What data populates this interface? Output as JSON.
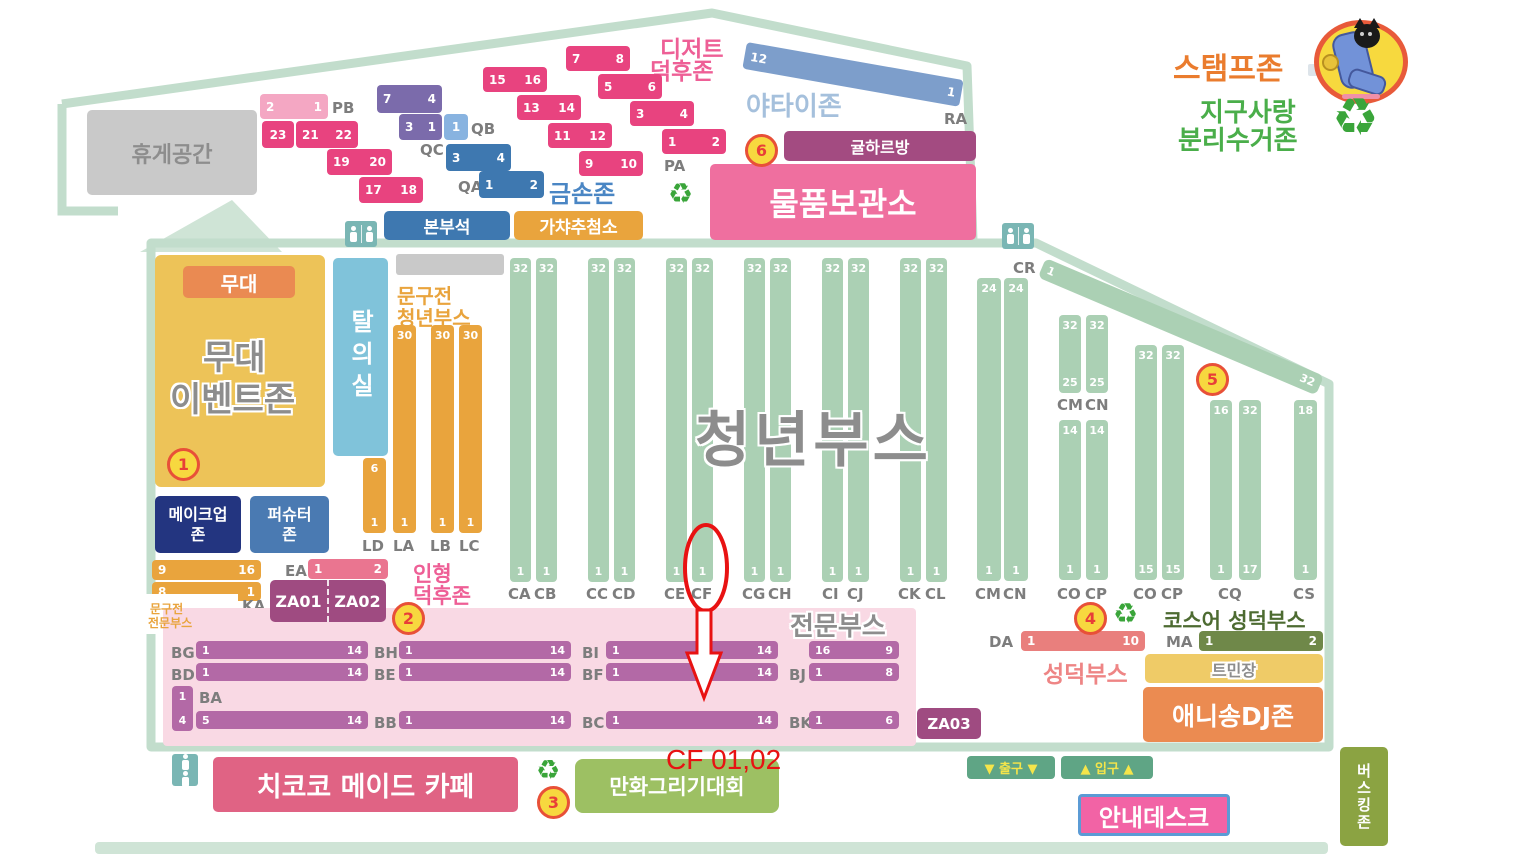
{
  "annotation": {
    "label": "CF 01,02"
  },
  "header": {
    "stamp_zone": "스탬프존",
    "earth_line1": "지구사랑",
    "earth_line2": "분리수거존"
  },
  "icons": {
    "recycle": "♻"
  },
  "rest_area": {
    "label": "휴게공간"
  },
  "nw": {
    "pb": {
      "label": "PB",
      "a": "2",
      "b": "1"
    },
    "b23": {
      "a": "23"
    },
    "b2122": {
      "a": "21",
      "b": "22"
    },
    "b1920": {
      "a": "19",
      "b": "20"
    },
    "b1718": {
      "a": "17",
      "b": "18"
    },
    "v74": {
      "a": "7",
      "b": "4"
    },
    "v31": {
      "a": "3",
      "b": "1"
    },
    "qb": {
      "label": "QB",
      "a": "1"
    },
    "qc_label": "QC",
    "b34": {
      "a": "3",
      "b": "4"
    },
    "qa": {
      "label": "QA",
      "a": "1",
      "b": "2"
    },
    "goldhand": "금손존",
    "hq": "본부석",
    "gacha": "가챠추첨소"
  },
  "dessert": {
    "title1": "디저트",
    "title2": "덕후존",
    "d78": {
      "a": "7",
      "b": "8"
    },
    "d1516": {
      "a": "15",
      "b": "16"
    },
    "d56": {
      "a": "5",
      "b": "6"
    },
    "d1314": {
      "a": "13",
      "b": "14"
    },
    "d34": {
      "a": "3",
      "b": "4"
    },
    "d1112": {
      "a": "11",
      "b": "12"
    },
    "d12": {
      "a": "1",
      "b": "2"
    },
    "d910": {
      "a": "9",
      "b": "10"
    },
    "pa_label": "PA"
  },
  "ne": {
    "yatai": "야타이존",
    "ra": {
      "label": "RA",
      "a": "12",
      "b": "1"
    },
    "gyul": "귤하르방",
    "storage": "물품보관소"
  },
  "markers": {
    "m1": "1",
    "m2": "2",
    "m3": "3",
    "m4": "4",
    "m5": "5",
    "m6": "6"
  },
  "stage": {
    "header": "무대",
    "title1": "무대",
    "title2": "이벤트존"
  },
  "dressing": {
    "label": "탈의실"
  },
  "stationery_youth": {
    "title1": "문구전",
    "title2": "청년부스",
    "ld": {
      "label": "LD",
      "top": "6",
      "bottom": "1"
    },
    "la": {
      "label": "LA",
      "top": "30",
      "bottom": "1"
    },
    "lb": {
      "label": "LB",
      "top": "30",
      "bottom": "1"
    },
    "lc": {
      "label": "LC",
      "top": "30",
      "bottom": "1"
    }
  },
  "makeup": {
    "line1": "메이크업",
    "line2": "존"
  },
  "fursuiter": {
    "line1": "퍼슈터",
    "line2": "존"
  },
  "stationery_pro": {
    "bar1": {
      "a": "9",
      "b": "16"
    },
    "bar2": {
      "a": "8",
      "b": "1"
    },
    "ka_label": "KA",
    "title1": "문구전",
    "title2": "전문부스"
  },
  "doll": {
    "ea_label": "EA",
    "bar": {
      "a": "1",
      "b": "2"
    },
    "title1": "인형",
    "title2": "덕후존"
  },
  "za": {
    "za01": "ZA01",
    "za02": "ZA02",
    "za03": "ZA03"
  },
  "youth": {
    "title": "청년부스",
    "ca": {
      "label": "CA",
      "top": "32",
      "bottom": "1"
    },
    "cb": {
      "label": "CB",
      "top": "32",
      "bottom": "1"
    },
    "cc": {
      "label": "CC",
      "top": "32",
      "bottom": "1"
    },
    "cd": {
      "label": "CD",
      "top": "32",
      "bottom": "1"
    },
    "ce": {
      "label": "CE",
      "top": "32",
      "bottom": "1"
    },
    "cf": {
      "label": "CF",
      "top": "32",
      "bottom": "1"
    },
    "cg": {
      "label": "CG",
      "top": "32",
      "bottom": "1"
    },
    "ch": {
      "label": "CH",
      "top": "32",
      "bottom": "1"
    },
    "ci": {
      "label": "CI",
      "top": "32",
      "bottom": "1"
    },
    "cj": {
      "label": "CJ",
      "top": "32",
      "bottom": "1"
    },
    "ck": {
      "label": "CK",
      "top": "32",
      "bottom": "1"
    },
    "cl": {
      "label": "CL",
      "top": "32",
      "bottom": "1"
    },
    "cm_tall": {
      "label": "CM",
      "top": "24",
      "bottom": "1"
    },
    "cn_tall": {
      "label": "CN",
      "top": "24",
      "bottom": "1"
    },
    "cm_s": {
      "label": "CM",
      "top": "32",
      "bottom": "25"
    },
    "cn_s": {
      "label": "CN",
      "top": "32",
      "bottom": "25"
    },
    "co_s": {
      "label": "CO",
      "top": "14",
      "bottom": "1"
    },
    "cp_s": {
      "label": "CP",
      "top": "14",
      "bottom": "1"
    },
    "co_t": {
      "label": "CO",
      "top": "32",
      "bottom": "15"
    },
    "cp_t": {
      "label": "CP",
      "top": "32",
      "bottom": "15"
    },
    "cq1": {
      "top": "16",
      "bottom": "1"
    },
    "cq2": {
      "top": "32",
      "bottom": "17"
    },
    "cq_label": "CQ",
    "cs": {
      "label": "CS",
      "top": "18",
      "bottom": "1"
    },
    "cr": {
      "label": "CR",
      "a": "1",
      "b": "32"
    }
  },
  "pro_booths": {
    "title": "전문부스",
    "bg": {
      "label": "BG",
      "a": "1",
      "b": "14"
    },
    "bh": {
      "label": "BH",
      "a": "1",
      "b": "14"
    },
    "bi": {
      "label": "BI",
      "a": "1",
      "b": "14"
    },
    "bj_top": {
      "a": "16",
      "b": "9"
    },
    "bd": {
      "label": "BD",
      "a": "1",
      "b": "14"
    },
    "be": {
      "label": "BE",
      "a": "1",
      "b": "14"
    },
    "bf": {
      "label": "BF",
      "a": "1",
      "b": "14"
    },
    "bj": {
      "label": "BJ",
      "a": "1",
      "b": "8"
    },
    "ba": {
      "label": "BA",
      "top": "1",
      "bottom": "4"
    },
    "ba_h": {
      "a": "5",
      "b": "14"
    },
    "bb": {
      "label": "BB",
      "a": "1",
      "b": "14"
    },
    "bc": {
      "label": "BC",
      "a": "1",
      "b": "14"
    },
    "bk": {
      "label": "BK",
      "a": "1",
      "b": "6"
    }
  },
  "se": {
    "cos_title": "코스어 성덕부스",
    "da": {
      "label": "DA",
      "a": "1",
      "b": "10"
    },
    "ma": {
      "label": "MA",
      "a": "1",
      "b": "2"
    },
    "seongdeok": "성덕부스",
    "tmin": "트민장",
    "anisong": "애니송DJ존"
  },
  "bottom": {
    "maid_cafe": "치코코 메이드 카페",
    "drawing": "만화그리기대회",
    "exit": "▼ 출구 ▼",
    "entrance": "▲ 입구 ▲",
    "info": "안내데스크",
    "busking": "버스킹존"
  }
}
